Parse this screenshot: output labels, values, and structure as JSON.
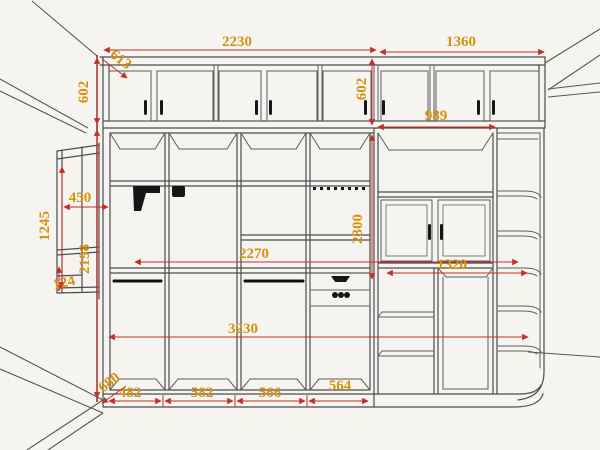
{
  "drawing": {
    "background": "#f5f4f1",
    "line_color": "#4c4c4c",
    "dim_line_color": "#c23028",
    "dim_text_color": "#d6920c",
    "dimensions": {
      "top_left_width": "2230",
      "top_right_width": "1360",
      "top_depth": "613",
      "upper_cabinet_height_left": "602",
      "upper_cabinet_height_right": "602",
      "upper_right_width": "989",
      "side_unit_height": "1245",
      "side_unit_width": "450",
      "left_body_height": "2198",
      "side_unit_bottom": "124",
      "interior_width": "2270",
      "right_body_height": "2300",
      "right_section_width": "1320",
      "overall_width": "3230",
      "base_depth": "680",
      "column_widths": [
        "482",
        "582",
        "566",
        "564"
      ]
    }
  }
}
